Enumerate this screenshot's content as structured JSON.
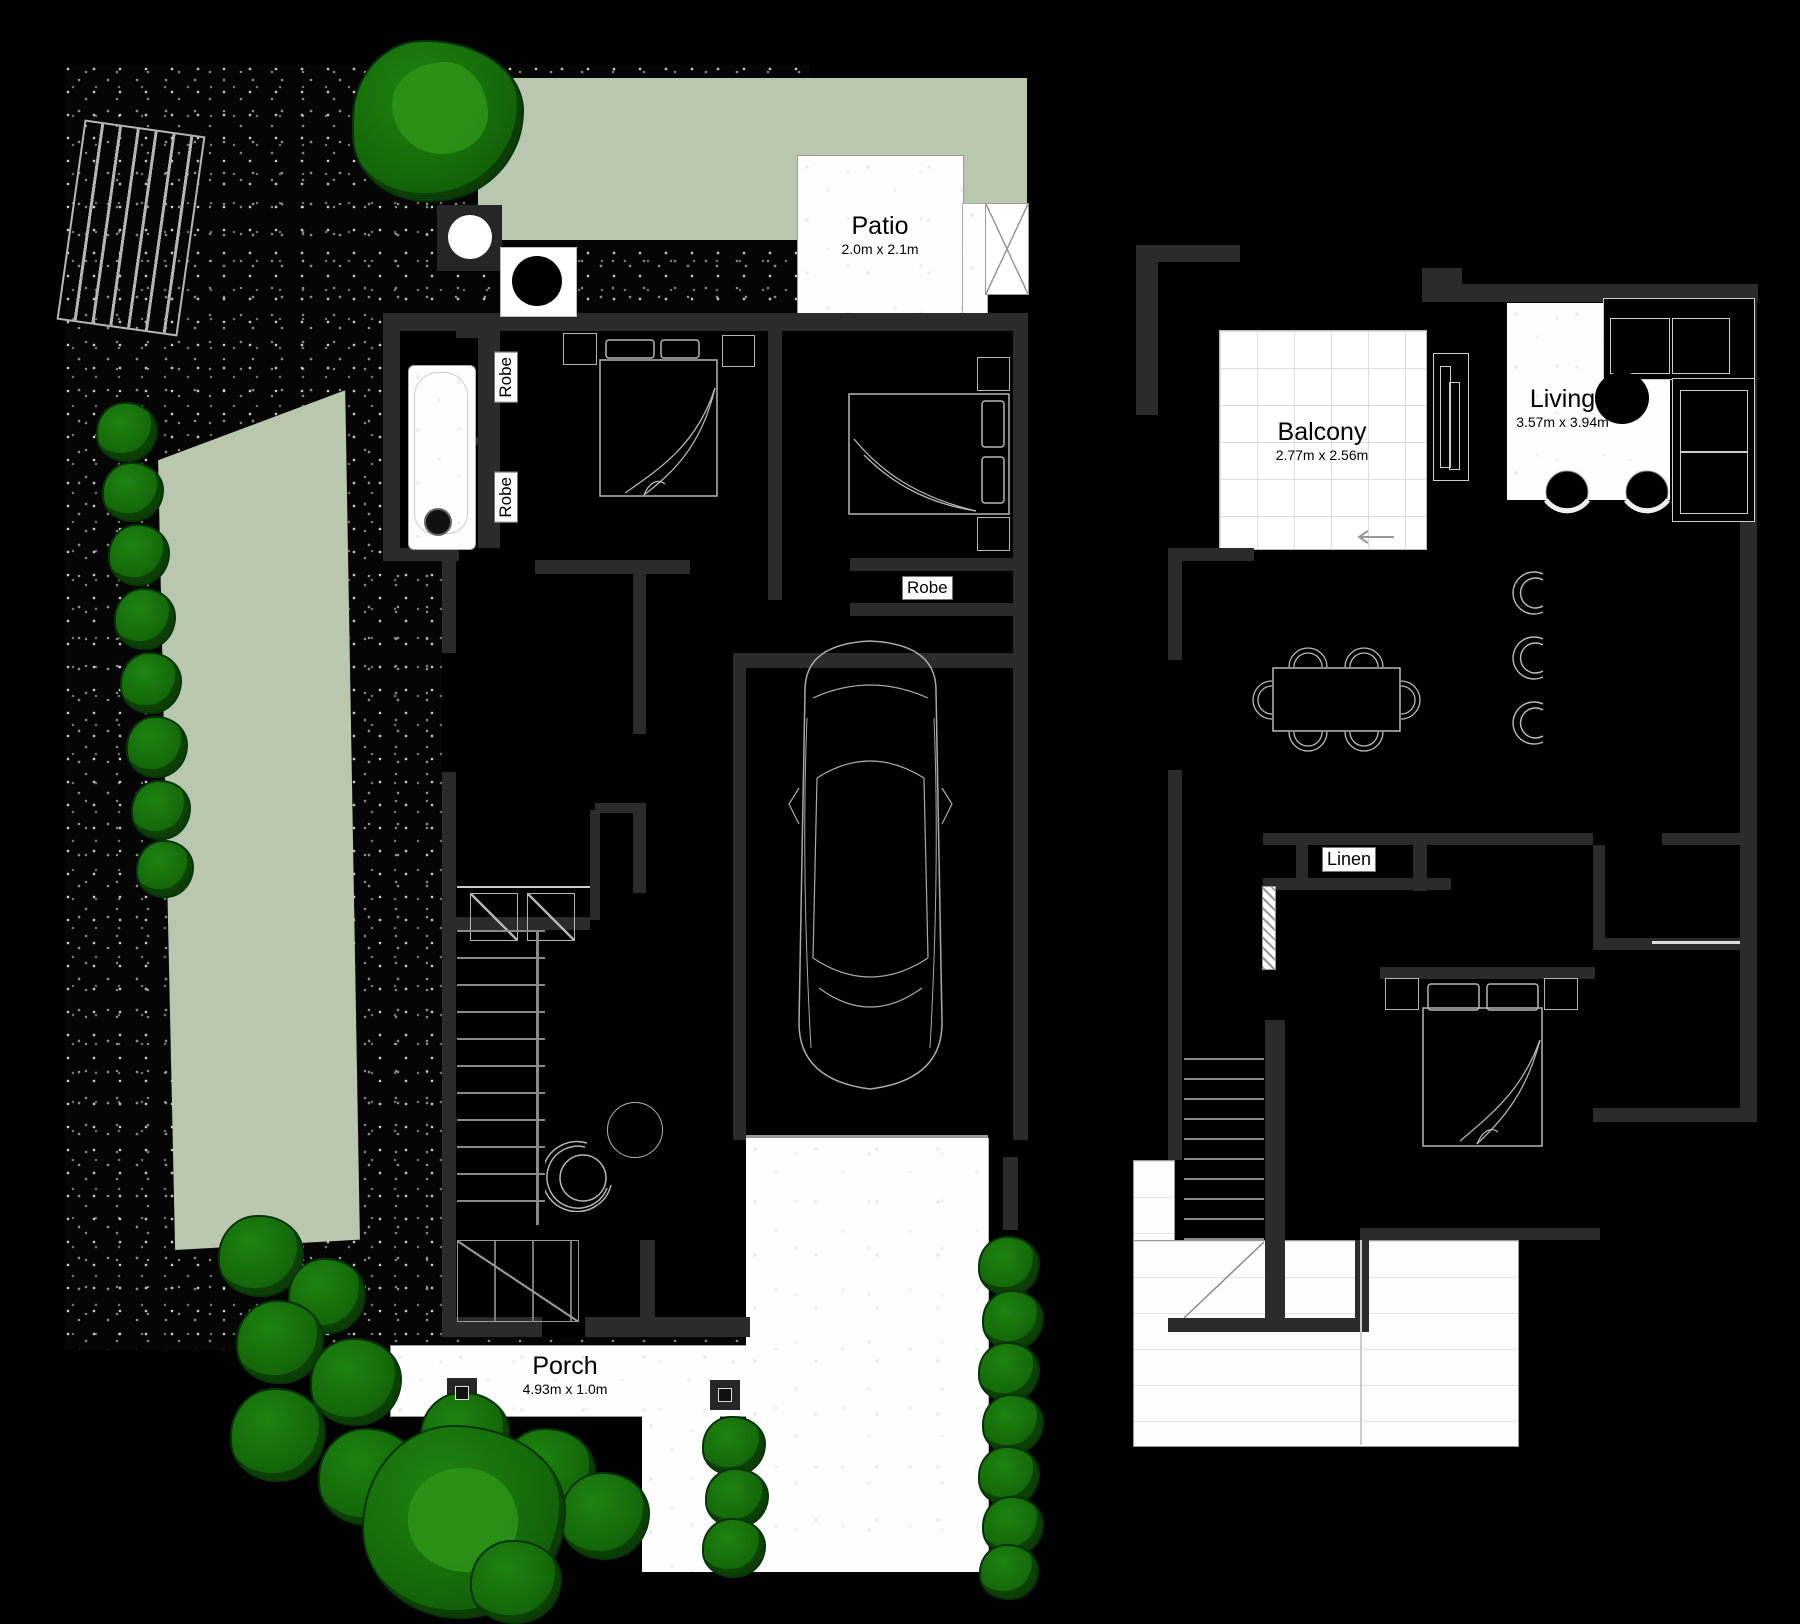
{
  "ground_floor": {
    "patio": {
      "name": "Patio",
      "dims": "2.0m x 2.1m"
    },
    "porch": {
      "name": "Porch",
      "dims": "4.93m x 1.0m"
    },
    "robe_left_top": "Robe",
    "robe_left_bottom": "Robe",
    "robe_bed2": "Robe"
  },
  "first_floor": {
    "balcony": {
      "name": "Balcony",
      "dims": "2.77m x 2.56m"
    },
    "living": {
      "name": "Living",
      "dims": "3.57m x 3.94m"
    },
    "linen": "Linen"
  },
  "colors": {
    "background": "#000000",
    "wall": "#2b2b2b",
    "lawn_green": "#b8c7ae",
    "bush_green": "#15700a",
    "concrete_white": "#ffffff"
  }
}
